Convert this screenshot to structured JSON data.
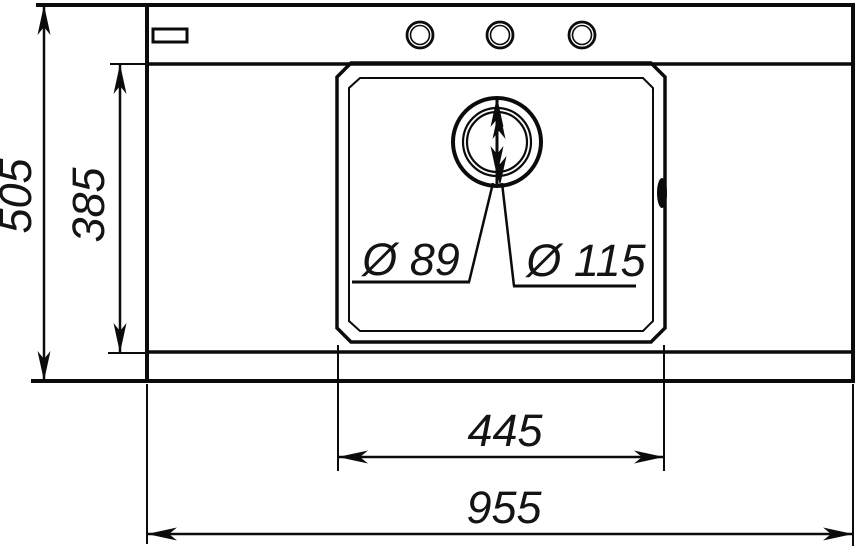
{
  "drawing": {
    "title": "kitchen-sink-top-view-technical-drawing",
    "colors": {
      "line": "#0b0b0b",
      "background": "#ffffff"
    },
    "dimensions": {
      "overall_height": "505",
      "inner_height": "385",
      "bowl_width": "445",
      "overall_width": "955",
      "drain_hole_diameter": "Ø 89",
      "drain_outer_diameter": "Ø 115"
    }
  }
}
